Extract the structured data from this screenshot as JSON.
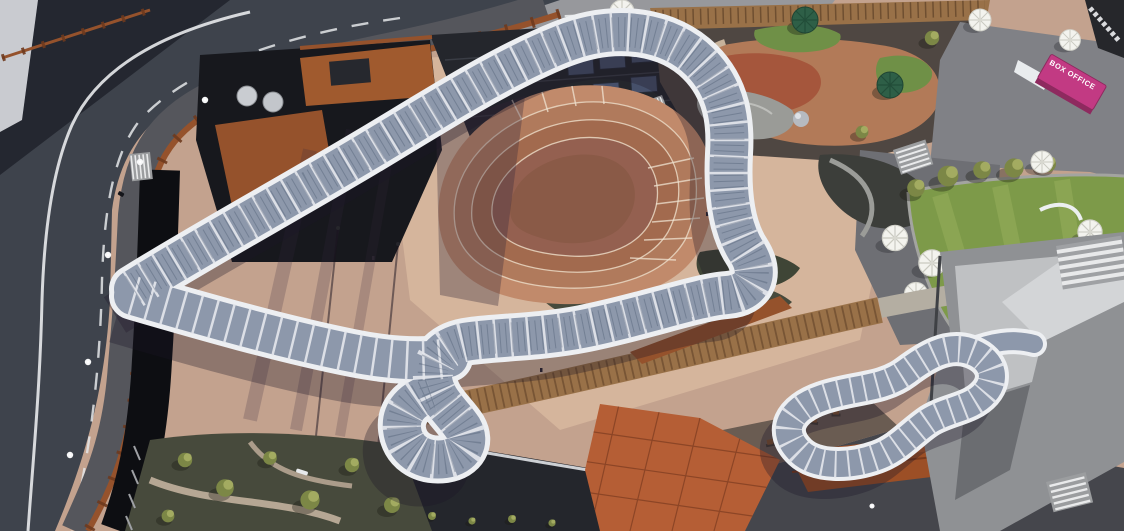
{
  "scene": {
    "labels": {
      "box_office": "BOX OFFICE"
    }
  },
  "palette": {
    "base": "#c3a28e",
    "plaza_light": "#d8b89f",
    "road": "#3e434c",
    "road_dark": "#2a2e36",
    "street": "#97989c",
    "marking": "#eceef0",
    "sidewalk": "#55565c",
    "void": "#0d0e12",
    "corten": "#95522c",
    "corten_dark": "#6e3a1e",
    "roof_dark": "#24262c",
    "roof_mid": "#2b2d33",
    "solar": "#46506a",
    "canopy_edge": "#edeff2",
    "canopy_mesh": "#8d98ab",
    "canopy_rib": "#e4e7ec",
    "terrace1": "#c18a6b",
    "terrace2": "#b07a5c",
    "terrace3": "#a26a4e",
    "terrace4": "#946050",
    "terrace5": "#8a5a47",
    "step_line": "#ead9c4",
    "lawn": "#7d9a49",
    "lawn_light": "#9ab15d",
    "tree": "#7c8746",
    "tree_light": "#aab266",
    "sand": "#b27a58",
    "play_red": "#a5563c",
    "water_gray": "#9a9b97",
    "turf": "#6f9047",
    "umbrella_white": "#f3f3ee",
    "umbrella_green": "#2e5f47",
    "pink_container": "#c23a83",
    "deck": "#997148",
    "terracotta": "#b55e35",
    "terracotta_line": "#8c4526",
    "corten_roof": "#9c4f26",
    "struct_light": "#bfc1c3",
    "struct_mid": "#8f9194",
    "pave_dark": "#45464c",
    "garden_dark": "#474a3c",
    "lamp": "#f7f8f9",
    "shadow": "rgba(28,22,38,0.33)"
  }
}
